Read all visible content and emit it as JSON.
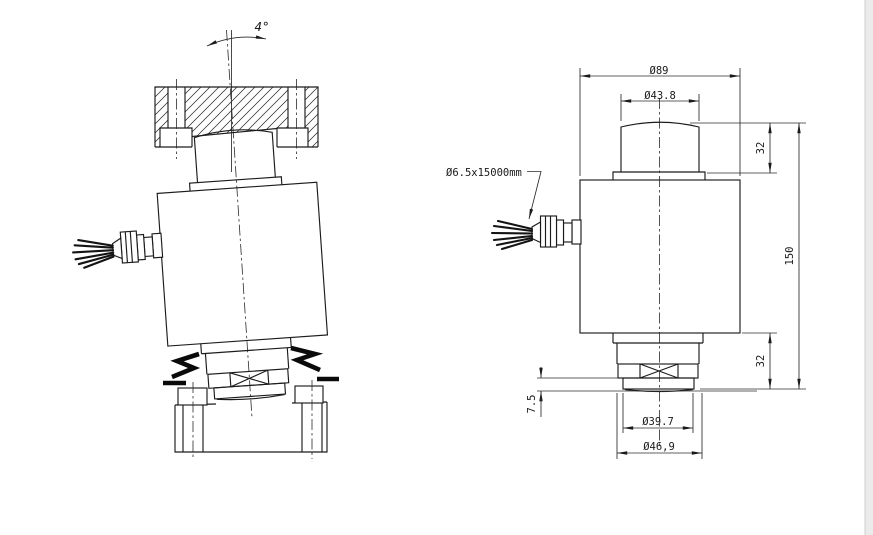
{
  "drawing": {
    "annotations": {
      "tilt_angle": "4°",
      "cable_spec": "Ø6.5x15000mm"
    },
    "dimensions": {
      "overall_diameter": "Ø89",
      "load_button_diameter": "Ø43.8",
      "top_section_height": "32",
      "total_height": "150",
      "bottom_section_height": "32",
      "base_clearance": "7.5",
      "base_inner_diameter": "Ø39.7",
      "base_outer_diameter": "Ø46,9"
    },
    "colors": {
      "line": "#1c1c1c",
      "background": "#ffffff"
    }
  }
}
